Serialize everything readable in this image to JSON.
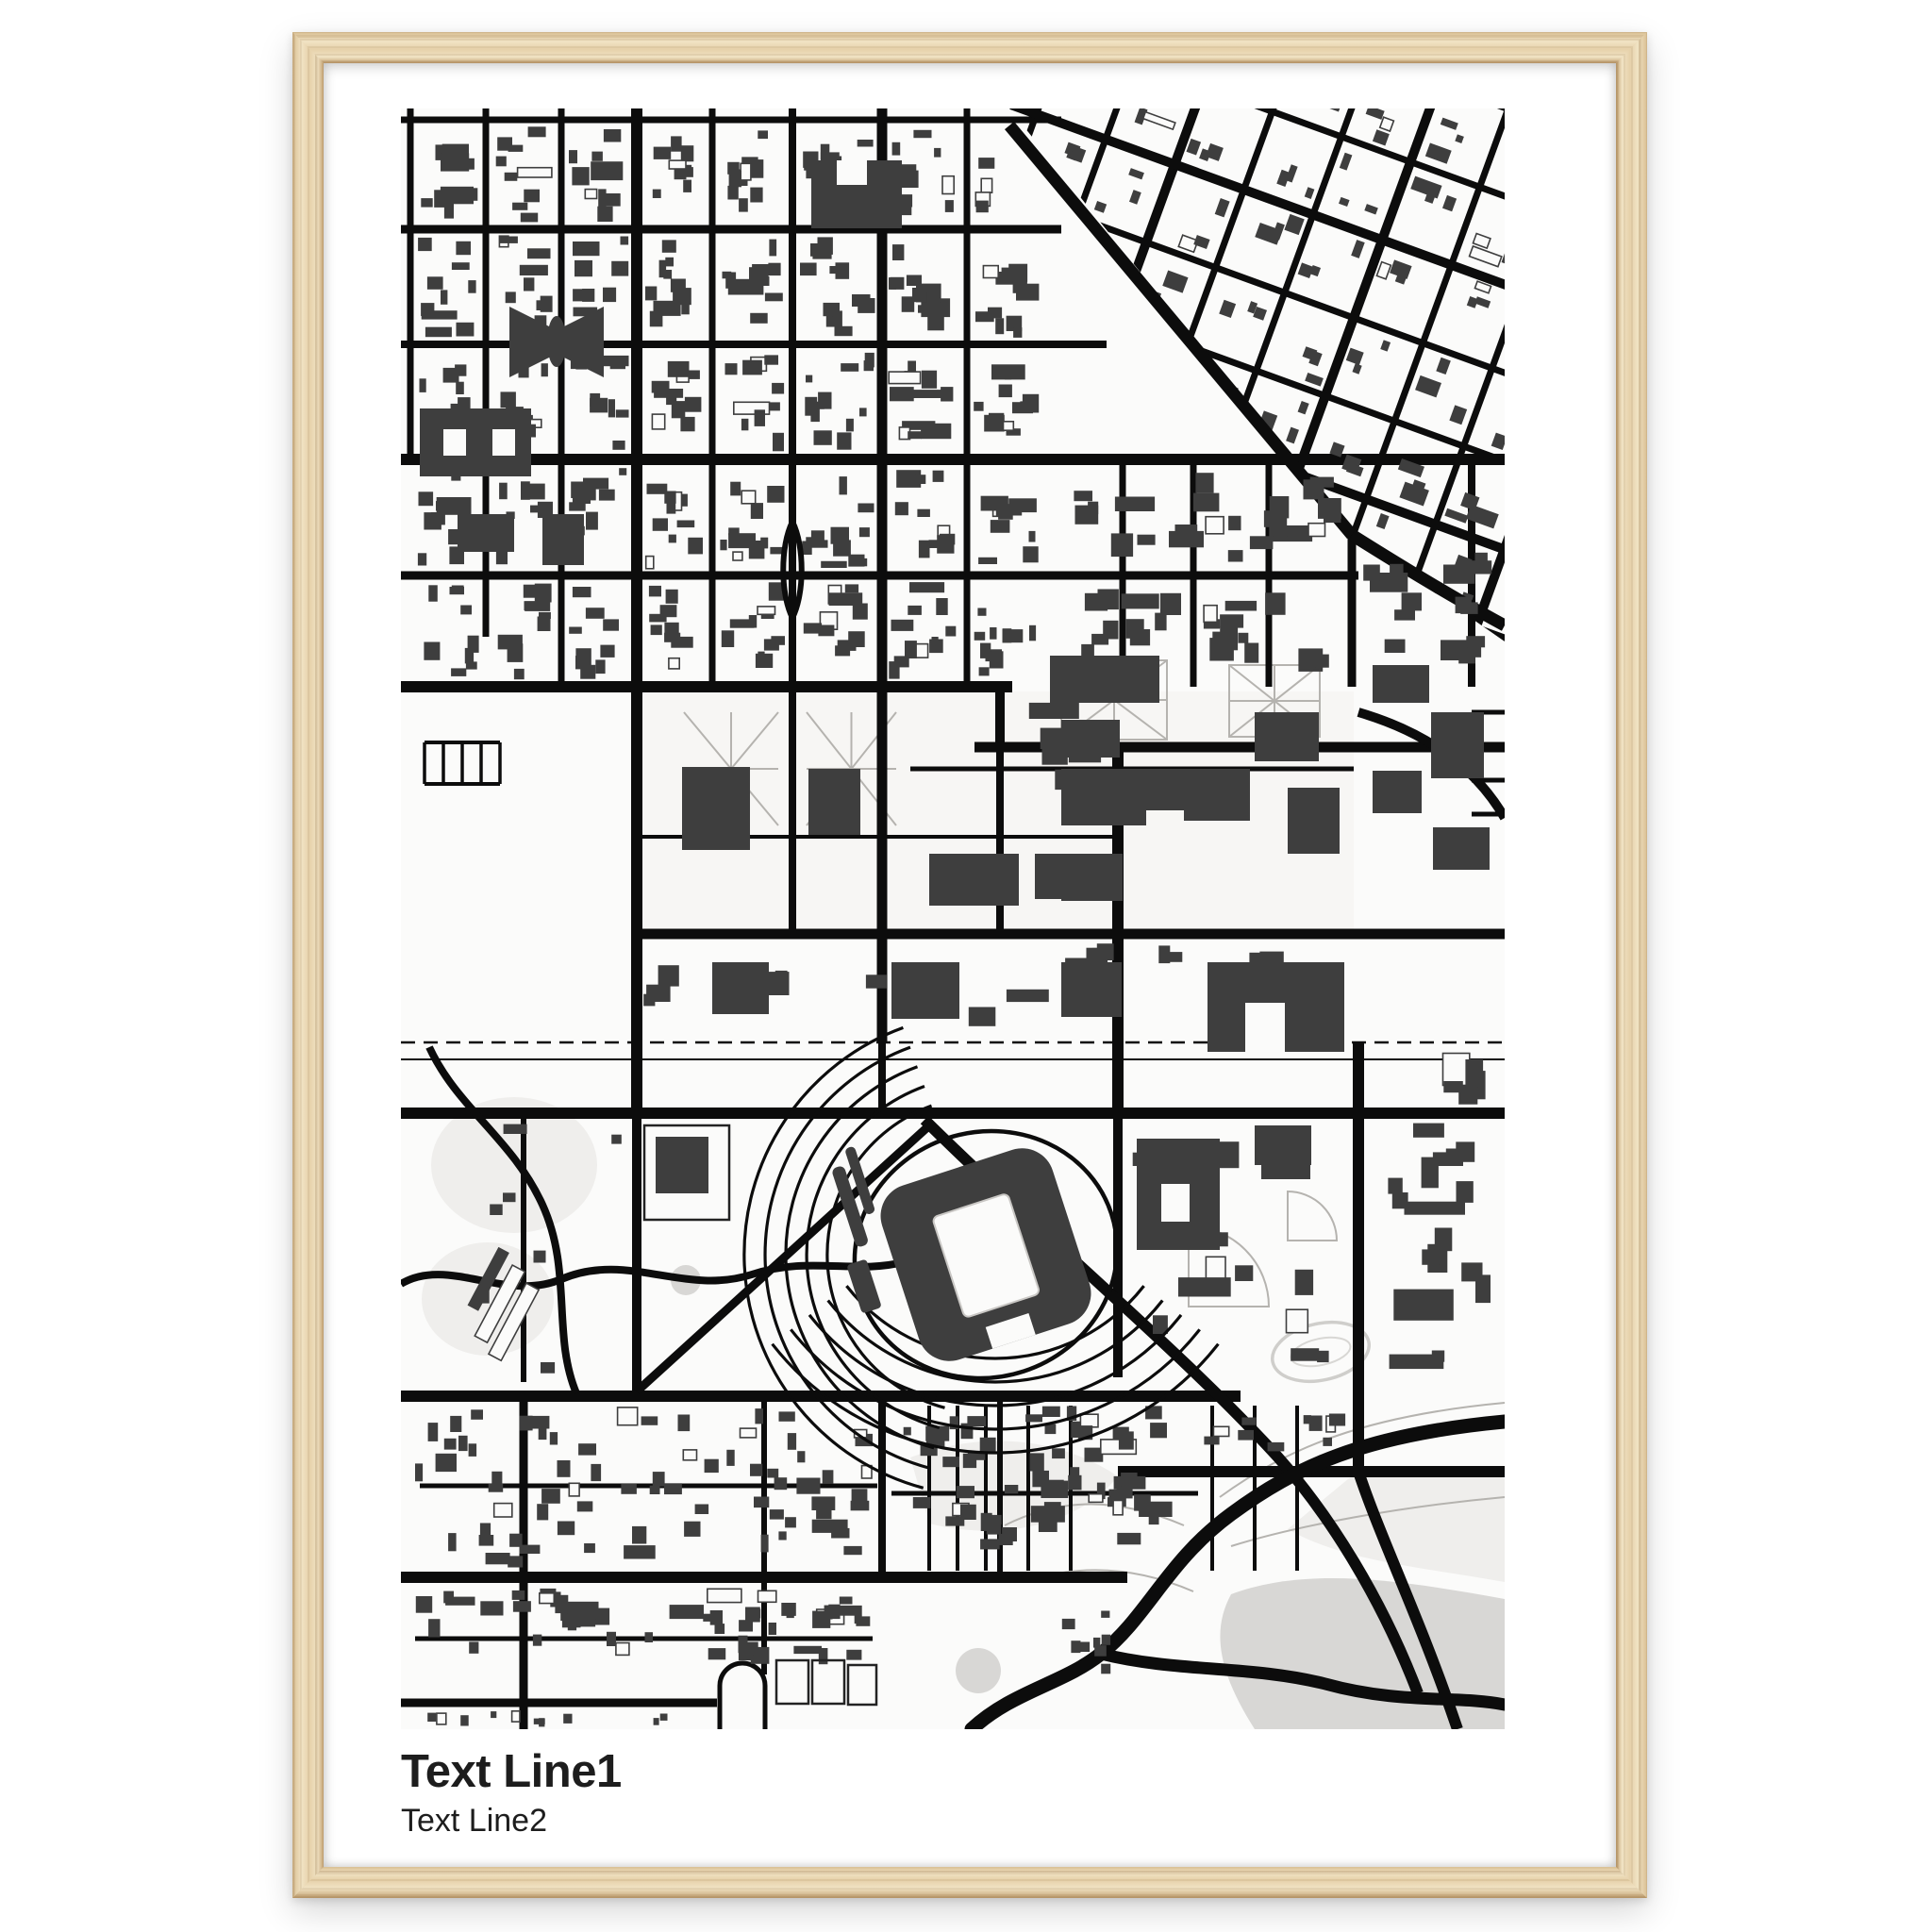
{
  "poster": {
    "title_line1": "Text Line1",
    "title_line2": "Text Line2"
  },
  "colors": {
    "page_bg": "#ffffff",
    "frame_wood_light": "#f1e3c4",
    "frame_wood_base": "#e6d1aa",
    "frame_wood_mid": "#d9bf93",
    "frame_wood_dark": "#c2a172",
    "mat": "#ffffff",
    "map_bg": "#fbfbfa",
    "road": "#0c0c0c",
    "building": "#3e3e3e",
    "water": "#d8d7d5",
    "park": "#efeeec",
    "path_gray": "#b5b3af",
    "rail": "#161616",
    "text": "#1d1d1d"
  }
}
